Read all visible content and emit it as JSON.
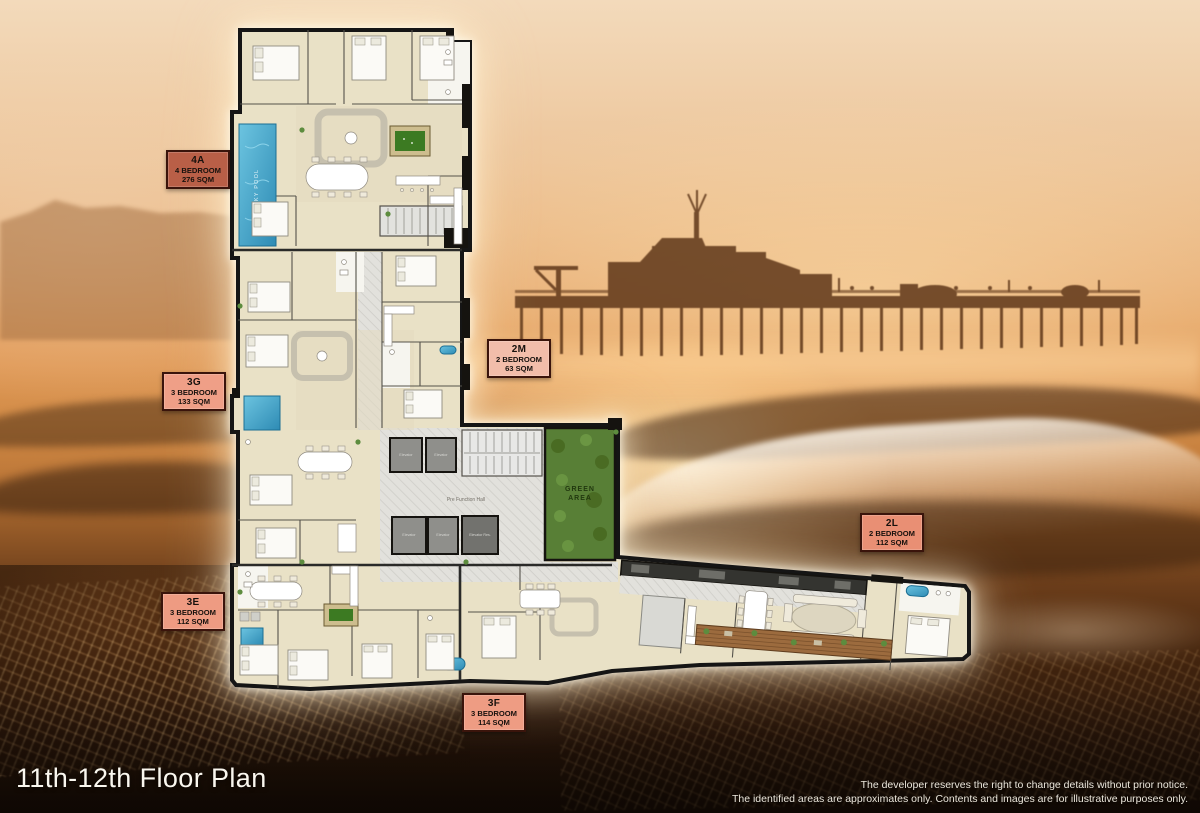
{
  "title": "11th-12th Floor Plan",
  "disclaimer": {
    "line1": "The developer reserves the right to change details without prior notice.",
    "line2": "The identified areas are approximates only.  Contents and images are for illustrative purposes only."
  },
  "units": [
    {
      "id": "4A",
      "bedrooms": "4 BEDROOM",
      "area": "276 SQM",
      "badge_color": "#b95f47"
    },
    {
      "id": "3G",
      "bedrooms": "3 BEDROOM",
      "area": "133 SQM",
      "badge_color": "#ef9f87"
    },
    {
      "id": "2M",
      "bedrooms": "2 BEDROOM",
      "area": "63 SQM",
      "badge_color": "#f2bdaa"
    },
    {
      "id": "2L",
      "bedrooms": "2 BEDROOM",
      "area": "112 SQM",
      "badge_color": "#e98f74"
    },
    {
      "id": "3E",
      "bedrooms": "3 BEDROOM",
      "area": "112 SQM",
      "badge_color": "#ee9b82"
    },
    {
      "id": "3F",
      "bedrooms": "3 BEDROOM",
      "area": "114 SQM",
      "badge_color": "#ee9c83"
    }
  ],
  "plan_labels": {
    "green_area_line1": "GREEN",
    "green_area_line2": "AREA",
    "pre_function_hall": "Pre Function Hall",
    "sky_pool": "SKY POOL",
    "elevator": "Elevator",
    "elevator_res": "Elevator Res."
  },
  "colors": {
    "badge_border": "#3a140b",
    "plan_floor": "#e9e1c6",
    "pool_blue": "#4aa8cf",
    "green_area": "#587f36"
  }
}
